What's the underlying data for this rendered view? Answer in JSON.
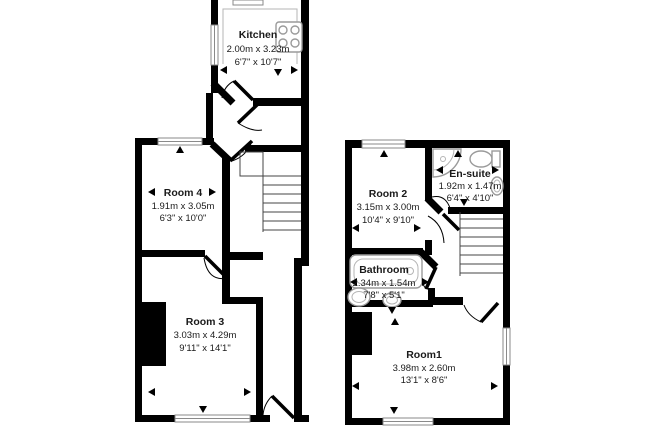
{
  "colors": {
    "wall": "#000000",
    "background": "#ffffff",
    "window_line": "#8a8a8a",
    "fixture_line": "#9a9a9a",
    "text": "#1a1a1a"
  },
  "rooms": {
    "kitchen": {
      "name": "Kitchen",
      "metric": "2.00m x 3.23m",
      "imperial": "6'7\" x 10'7\""
    },
    "room4": {
      "name": "Room 4",
      "metric": "1.91m x 3.05m",
      "imperial": "6'3\" x 10'0\""
    },
    "room3": {
      "name": "Room 3",
      "metric": "3.03m x 4.29m",
      "imperial": "9'11\" x 14'1\""
    },
    "room2": {
      "name": "Room 2",
      "metric": "3.15m x 3.00m",
      "imperial": "10'4\" x 9'10\""
    },
    "ensuite": {
      "name": "En-suite",
      "metric": "1.92m x 1.47m",
      "imperial": "6'4\" x 4'10\""
    },
    "bathroom": {
      "name": "Bathroom",
      "metric": "2.34m x 1.54m",
      "imperial": "7'8\" x 5'1\""
    },
    "room1": {
      "name": "Room1",
      "metric": "3.98m x 2.60m",
      "imperial": "13'1\" x 8'6\""
    }
  }
}
